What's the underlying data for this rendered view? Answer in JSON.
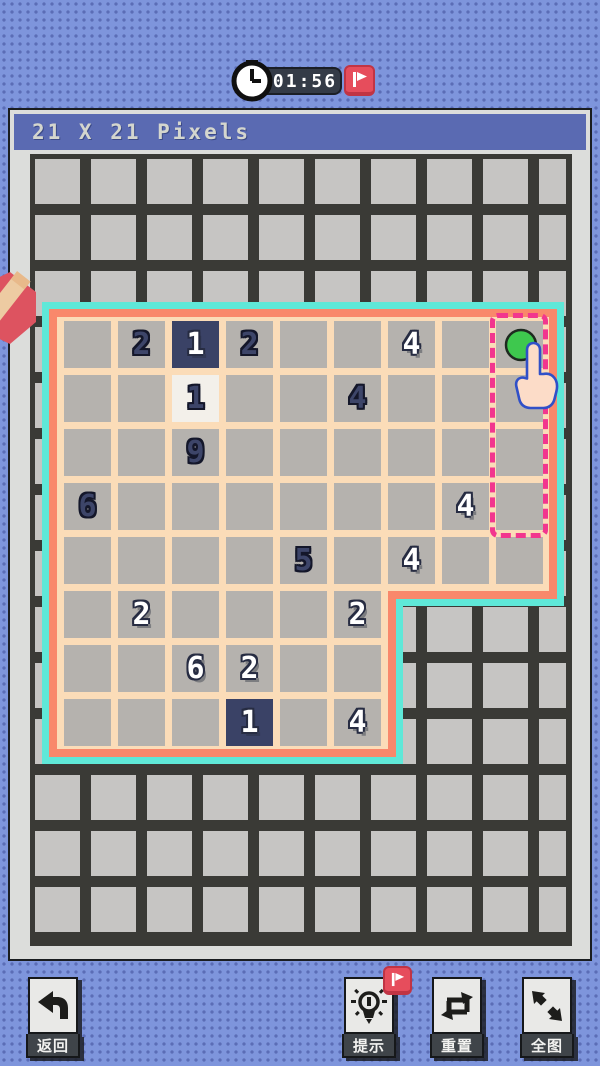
{
  "header": {
    "title": "21 X 21 Pixels",
    "bg_color": "#5a6ab2"
  },
  "timer": {
    "time": "01:56",
    "pill_color": "#343b47",
    "flag_button_color": "#e64d5c"
  },
  "board": {
    "grid_line_color": "#3a3a36",
    "grid_cell_color": "#c6c5c3"
  },
  "puzzle": {
    "rows": 8,
    "cols": 9,
    "border_outer_color": "#5fe8d8",
    "border_inner_color": "#f9886b",
    "interior_color": "#fbdcb8",
    "cell_color": "#b5b2ae",
    "cell_navy_color": "#3a4266",
    "cell_cream_color": "#f3f0ea",
    "cutout": {
      "row_start": 6,
      "col_start": 7
    },
    "numbers": [
      {
        "row": 1,
        "col": 2,
        "value": "2",
        "style": "navy",
        "bg": "gray"
      },
      {
        "row": 1,
        "col": 3,
        "value": "1",
        "style": "white",
        "bg": "navy"
      },
      {
        "row": 1,
        "col": 4,
        "value": "2",
        "style": "navy",
        "bg": "gray"
      },
      {
        "row": 1,
        "col": 7,
        "value": "4",
        "style": "white",
        "bg": "gray"
      },
      {
        "row": 1,
        "col": 9,
        "value": "4",
        "style": "navy",
        "bg": "gray"
      },
      {
        "row": 2,
        "col": 3,
        "value": "1",
        "style": "navy",
        "bg": "cream"
      },
      {
        "row": 2,
        "col": 6,
        "value": "4",
        "style": "navy",
        "bg": "gray"
      },
      {
        "row": 3,
        "col": 3,
        "value": "9",
        "style": "navy",
        "bg": "gray"
      },
      {
        "row": 4,
        "col": 1,
        "value": "6",
        "style": "navy",
        "bg": "gray"
      },
      {
        "row": 4,
        "col": 8,
        "value": "4",
        "style": "white",
        "bg": "gray"
      },
      {
        "row": 5,
        "col": 5,
        "value": "5",
        "style": "navy",
        "bg": "gray"
      },
      {
        "row": 5,
        "col": 7,
        "value": "4",
        "style": "white",
        "bg": "gray"
      },
      {
        "row": 6,
        "col": 2,
        "value": "2",
        "style": "white",
        "bg": "gray"
      },
      {
        "row": 6,
        "col": 6,
        "value": "2",
        "style": "white",
        "bg": "gray"
      },
      {
        "row": 7,
        "col": 3,
        "value": "6",
        "style": "white",
        "bg": "gray"
      },
      {
        "row": 7,
        "col": 4,
        "value": "2",
        "style": "white",
        "bg": "gray"
      },
      {
        "row": 8,
        "col": 4,
        "value": "1",
        "style": "white",
        "bg": "navy"
      },
      {
        "row": 8,
        "col": 6,
        "value": "4",
        "style": "white",
        "bg": "gray"
      }
    ],
    "selection": {
      "col": 9,
      "row_start": 1,
      "row_end": 4,
      "color": "#f2368e"
    },
    "cursor": {
      "dot_color": "#3ec84e",
      "hand_fill": "#fcdcc8",
      "hand_outline": "#3050c8"
    }
  },
  "toolbar": {
    "back_label": "返回",
    "hint_label": "提示",
    "reset_label": "重置",
    "full_label": "全图"
  },
  "icons": {
    "clock": "clock-icon",
    "flag": "flag-icon",
    "pencil": "pencil-badge-icon",
    "hand": "hand-cursor-icon",
    "back": "back-arrow-icon",
    "hint": "lightbulb-icon",
    "reset": "reset-loop-icon",
    "full": "expand-arrows-icon"
  }
}
